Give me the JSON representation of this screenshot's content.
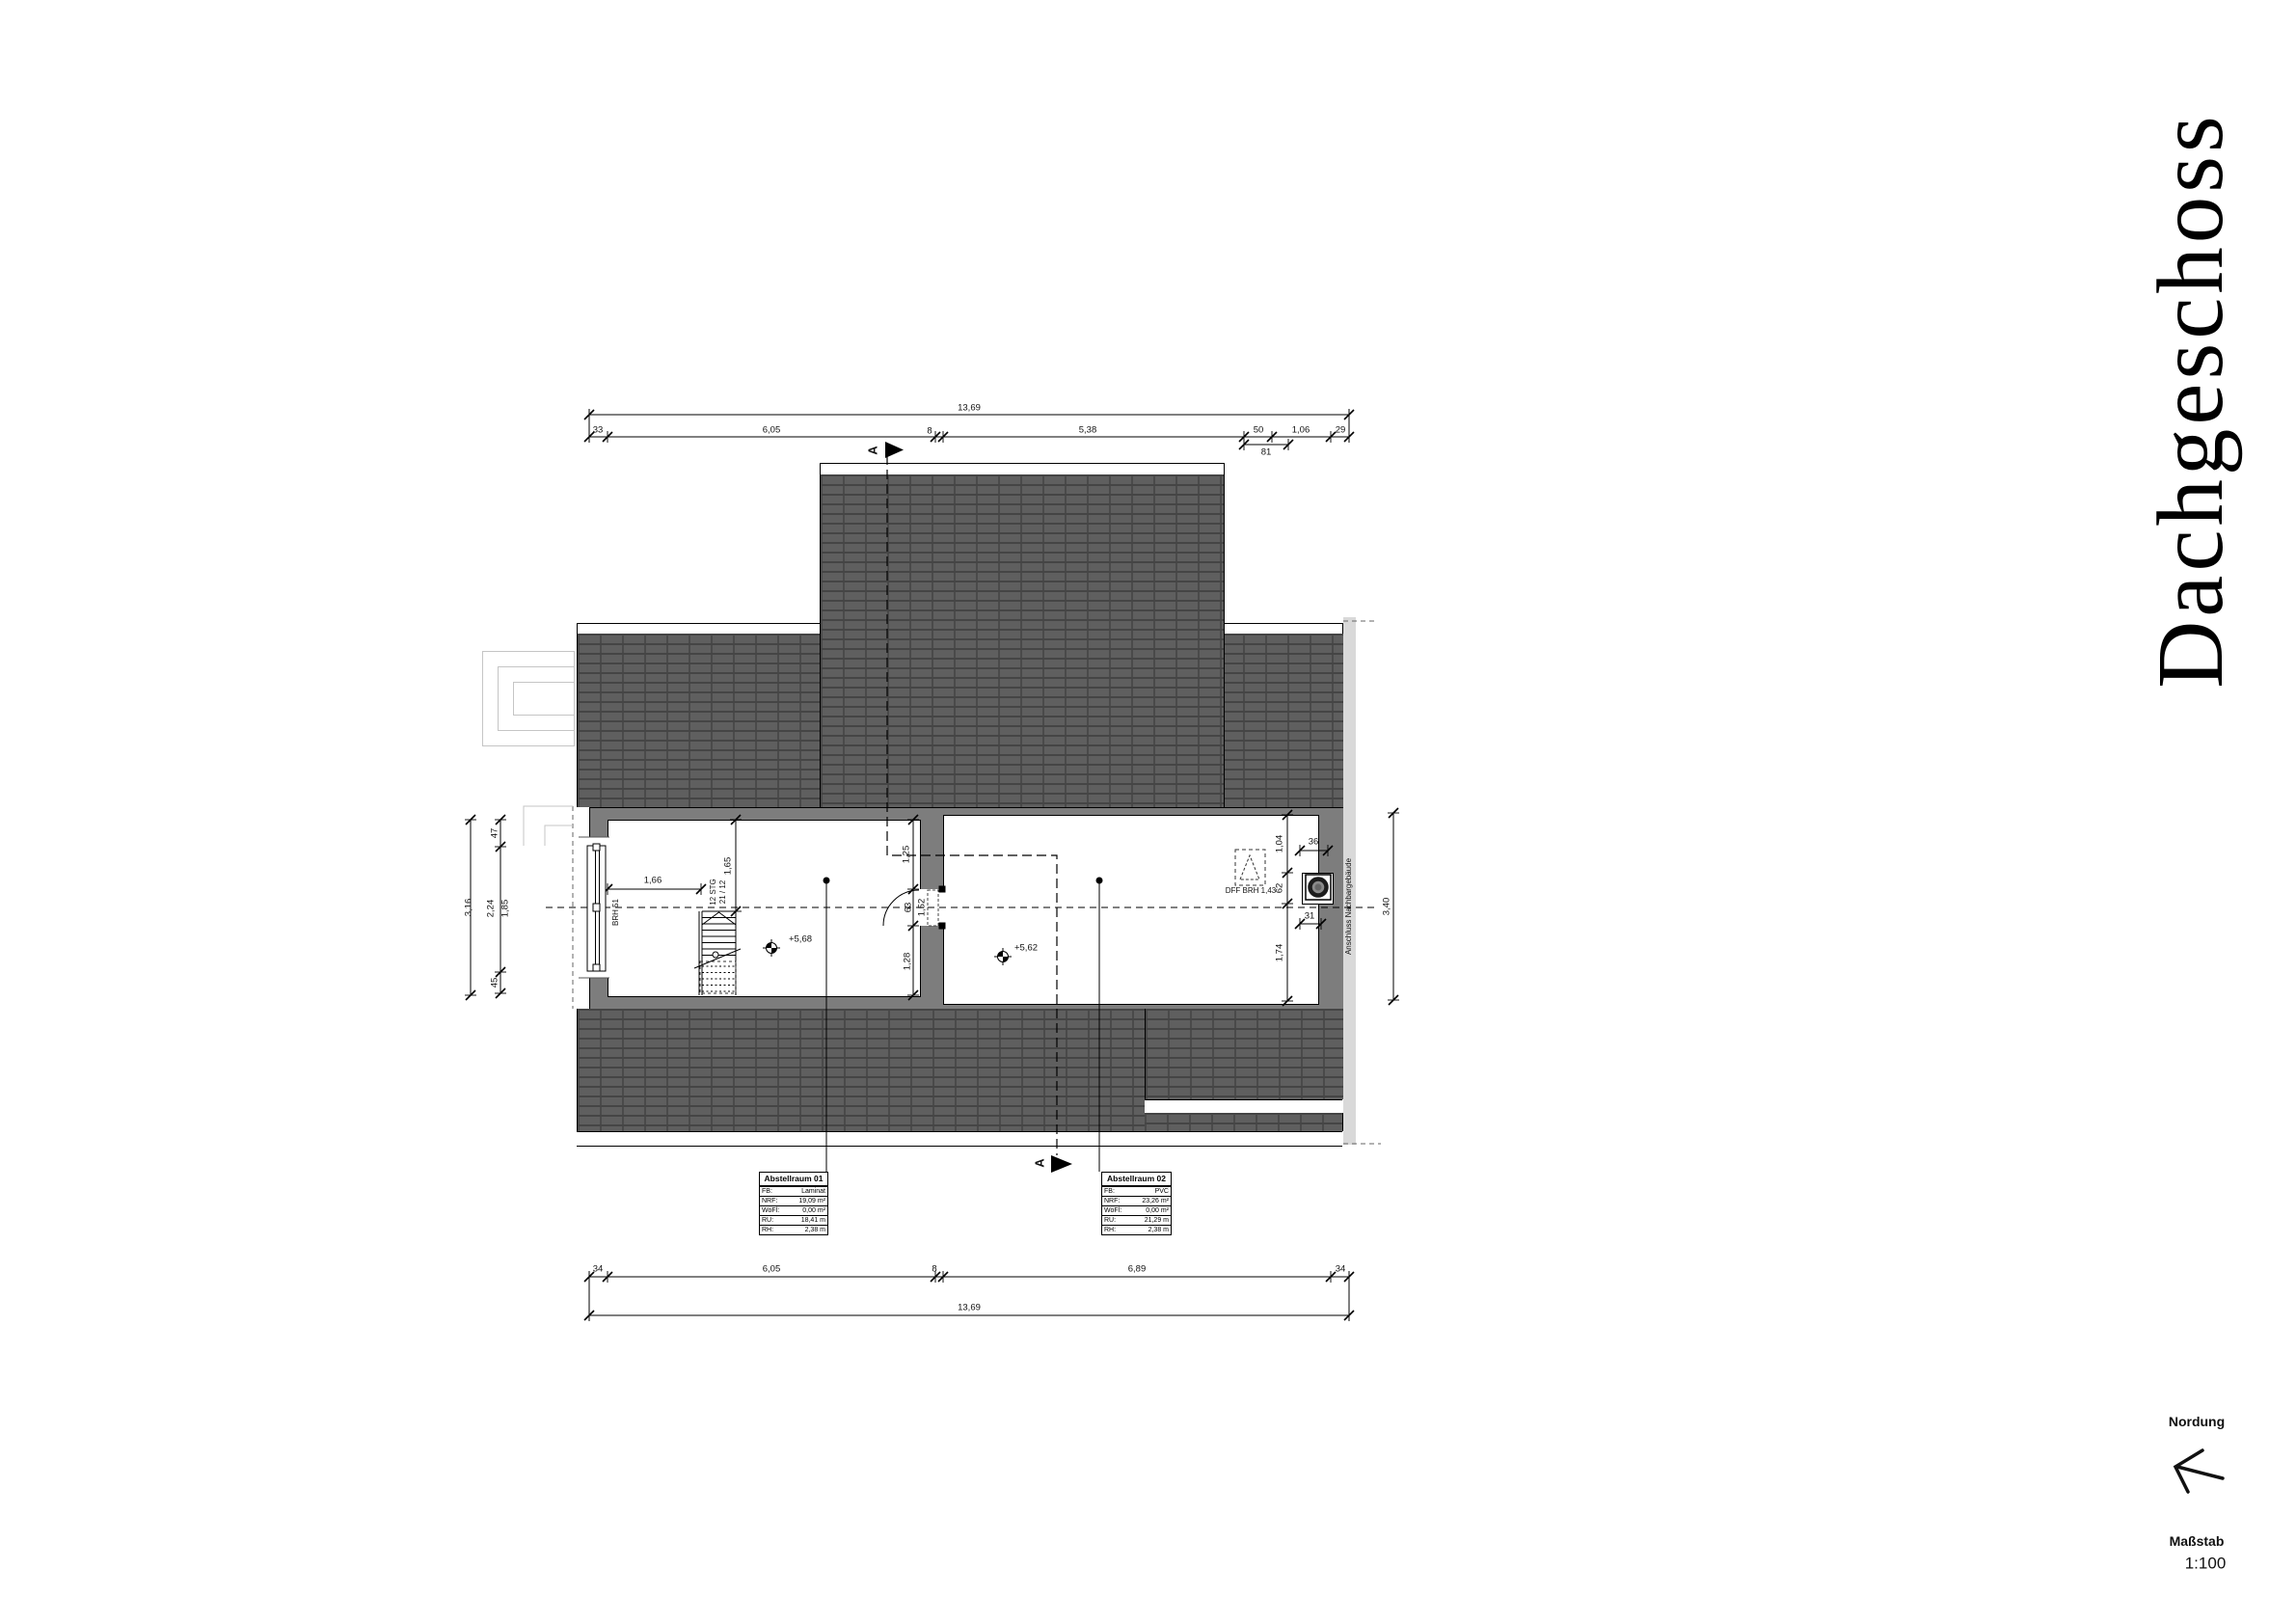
{
  "title": "Dachgeschoss",
  "north": {
    "label": "Nordung"
  },
  "scale": {
    "label": "Maßstab",
    "value": "1:100"
  },
  "section": {
    "letter": "A"
  },
  "neighbor_label": "Anschluss Nachbargebäude",
  "stair": {
    "line1": "12 STG",
    "line2": "21 / 12"
  },
  "window": {
    "sill_label": "BRH 51"
  },
  "roof_window": {
    "label": "DFF BRH 1,43"
  },
  "rooms": {
    "room1": {
      "level": "+5,68",
      "table": {
        "title": "Abstellraum 01",
        "rows": [
          [
            "FB:",
            "Laminat"
          ],
          [
            "NRF:",
            "19,09 m²"
          ],
          [
            "WoFl:",
            "0,00 m²"
          ],
          [
            "RU:",
            "18,41 m"
          ],
          [
            "RH:",
            "2,38 m"
          ]
        ]
      }
    },
    "room2": {
      "level": "+5,62",
      "table": {
        "title": "Abstellraum 02",
        "rows": [
          [
            "FB:",
            "PVC"
          ],
          [
            "NRF:",
            "23,26 m²"
          ],
          [
            "WoFl:",
            "0,00 m²"
          ],
          [
            "RU:",
            "21,29 m"
          ],
          [
            "RH:",
            "2,38 m"
          ]
        ]
      }
    }
  },
  "dimensions": {
    "top": {
      "total": "13,69",
      "c33": "33",
      "c605": "6,05",
      "c8": "8",
      "c538": "5,38",
      "c50": "50",
      "c81": "81",
      "c106": "1,06",
      "c29": "29"
    },
    "bottom": {
      "total": "13,69",
      "c34l": "34",
      "c605": "6,05",
      "c8": "8",
      "c689": "6,89",
      "c34r": "34"
    },
    "left": {
      "total": "3,16",
      "c47": "47",
      "c224": "2,24",
      "c185": "1,85",
      "c45": "45"
    },
    "right": {
      "total": "3,40",
      "c104": "1,04",
      "c62": "62",
      "c174": "1,74",
      "c36": "36",
      "c31": "31"
    },
    "door": {
      "c125": "1,25",
      "c63": "63",
      "c152": "1,52",
      "c128": "1,28"
    },
    "interior": {
      "c166": "1,66",
      "c165": "1,65"
    }
  }
}
